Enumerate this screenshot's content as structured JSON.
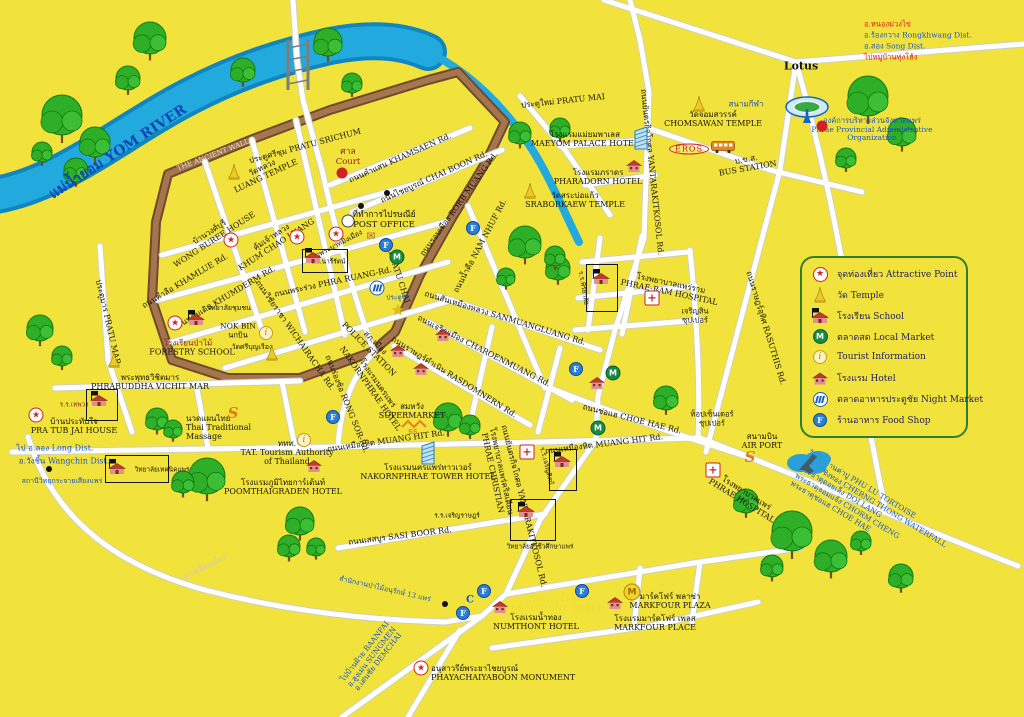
{
  "colors": {
    "background": "#f2e33c",
    "river": "#1b9cd6",
    "wall": "#6f4a2d",
    "road": "#ffffff",
    "thai_blue": "#1a57c4",
    "red": "#d42020",
    "legend_border": "#2e7d32"
  },
  "legend": {
    "items": [
      {
        "icon": "star",
        "text": "จุดท่องเที่ยว  Attractive Point"
      },
      {
        "icon": "temple",
        "text": "วัด  Temple"
      },
      {
        "icon": "school",
        "text": "โรงเรียน  School"
      },
      {
        "icon": "market",
        "text": "ตลาดสด  Local Market"
      },
      {
        "icon": "info",
        "text": "Tourist  Information"
      },
      {
        "icon": "hotel",
        "text": "โรงแรม  Hotel"
      },
      {
        "icon": "nightmarket",
        "text": "ตลาดอาหารประตูชัย  Night Market"
      },
      {
        "icon": "foodshop",
        "text": "ร้านอาหาร  Food Shop"
      }
    ]
  },
  "labels": [
    {
      "n": "yom-river-label",
      "t": "แม่น้ำยอม   YOM RIVER",
      "x": 118,
      "y": 152,
      "r": -33,
      "c": "#0d47b0",
      "s": 14,
      "w": 700
    },
    {
      "n": "ancient-wall-label",
      "t": "THE ANCIENT WALL",
      "x": 213,
      "y": 155,
      "r": -21,
      "c": "#e9e2cf",
      "s": 7
    },
    {
      "n": "pratu-srichum-label",
      "t": "ประตูศรีชุม PRATU SRICHUM",
      "x": 305,
      "y": 146,
      "r": -15
    },
    {
      "n": "court-label",
      "t": "ศาล\nCourt",
      "x": 348,
      "y": 158,
      "c": "#8c1f1f",
      "s": 8.5
    },
    {
      "n": "khamsaen-rd-label",
      "t": "ถนนคำแสน KHAMSAEN Rd.",
      "x": 400,
      "y": 158,
      "r": -24
    },
    {
      "n": "chaiboon-rd-label",
      "t": "ถนนไชยบูรณ์ CHAI BOON Rd.",
      "x": 434,
      "y": 177,
      "r": -24
    },
    {
      "n": "rorbmuang-rd-label",
      "t": "ถนนรอบเมือง RORB MUANG Rd.",
      "x": 459,
      "y": 204,
      "r": -54
    },
    {
      "n": "namnhue-rd-label",
      "t": "ถนนน้ำคือ NAM NHUF Rd.",
      "x": 480,
      "y": 246,
      "r": -62
    },
    {
      "n": "post-office-label",
      "t": "ที่ทำการไปรษณีย์\nPOST OFFICE",
      "x": 384,
      "y": 221,
      "s": 8.5
    },
    {
      "n": "luang-temple-label",
      "t": "วัดหลวง\nLUANG TEMPLE",
      "x": 264,
      "y": 172,
      "r": -25
    },
    {
      "n": "wongburee-house-label",
      "t": "บ้านวงศ์บุรี\nWONG BUREE HOUSE",
      "x": 212,
      "y": 236,
      "r": -33
    },
    {
      "n": "khumchao-luang-label",
      "t": "คุ้มเจ้าหลวง\nKHUM CHAO LUANG",
      "x": 274,
      "y": 241,
      "r": -33
    },
    {
      "n": "phrabat-temple-label",
      "t": "วัดพระบาทมิ่งเมือง",
      "x": 337,
      "y": 245,
      "r": -28,
      "s": 7
    },
    {
      "n": "nareerat-school-label",
      "t": "ร.ร.นารีรัตน์",
      "x": 328,
      "y": 262,
      "s": 6.5
    },
    {
      "n": "khamlue-rd-label",
      "t": "ถนนคำลือ KHAMLUE Rd.",
      "x": 185,
      "y": 281,
      "r": -31
    },
    {
      "n": "khumderm-rd-label",
      "t": "ถนนคุ้มเดิม KHUMDERM Rd.",
      "x": 226,
      "y": 297,
      "r": -31
    },
    {
      "n": "wichairacha-rd-label",
      "t": "ถนนวิชัยราชา WICHAIRACHA Rd.",
      "x": 295,
      "y": 335,
      "r": 55
    },
    {
      "n": "phraruang-rd-label",
      "t": "ถนนพระร่วง PHRA RUANG-Rd.",
      "x": 333,
      "y": 282,
      "r": -12
    },
    {
      "n": "phatuchai-label",
      "t": "PHATU CHAI",
      "x": 399,
      "y": 277,
      "r": 72
    },
    {
      "n": "phatuchai-thai-label",
      "t": "ประตูชัย",
      "x": 398,
      "y": 298,
      "c": "#1a57c4",
      "s": 6.5
    },
    {
      "n": "community-college-label",
      "t": "วิทยาลัยชุมชน",
      "x": 229,
      "y": 308,
      "s": 7
    },
    {
      "n": "nokbin-label",
      "t": "NOK BIN\nนกบิน",
      "x": 238,
      "y": 331,
      "s": 7.5
    },
    {
      "n": "sriboonruang-temple-label",
      "t": "วัดศรีบุญเรือง",
      "x": 252,
      "y": 347,
      "s": 7
    },
    {
      "n": "forestry-school-thai-label",
      "t": "โรงเรียนป่าไม้",
      "x": 188,
      "y": 343,
      "c": "#8c1f1f"
    },
    {
      "n": "forestry-school-label",
      "t": "FORESTRY SCHOOL",
      "x": 192,
      "y": 352
    },
    {
      "n": "pratumar-label",
      "t": "ประตูมาร PRATU MAR",
      "x": 108,
      "y": 322,
      "r": 77
    },
    {
      "n": "phrabuddha-vichitmar-label",
      "t": "พระพุทธวิชิตมาร\nPHRABUDDHA VICHIT MAR",
      "x": 150,
      "y": 382
    },
    {
      "n": "thepwong-school-label",
      "t": "ร.ร.เทพวง",
      "x": 74,
      "y": 405,
      "s": 6.5,
      "c": "#8c1f1f"
    },
    {
      "n": "pratubjai-house-label",
      "t": "บ้านประทับใจ\nPRA TUB JAI HOUSE",
      "x": 74,
      "y": 426
    },
    {
      "n": "long-dist-label",
      "t": "ไป อ.ลอง Long Dist.",
      "x": 55,
      "y": 448,
      "c": "#1a57c4"
    },
    {
      "n": "wangchin-dist-label",
      "t": "อ.วังชิ้น Wangchin Dist.",
      "x": 64,
      "y": 461,
      "c": "#1a57c4"
    },
    {
      "n": "radio-station-label",
      "t": "สถานีวิทยุกระจายเสียงแพร่",
      "x": 62,
      "y": 481,
      "s": 7,
      "c": "#1a57c4"
    },
    {
      "n": "technic-college-label",
      "t": "วิทยาลัยเทคนิคแพร่",
      "x": 162,
      "y": 470,
      "s": 6.5
    },
    {
      "n": "massage-label",
      "t": "นวดแผนไทย\nThai Traditional\nMassage",
      "x": 186,
      "y": 428,
      "a": "l"
    },
    {
      "n": "tat-label",
      "t": "ททท.\nTAT. Tourism Authority\nof Thailand",
      "x": 287,
      "y": 453
    },
    {
      "n": "poomthai-hotel-label",
      "t": "โรงแรมภูมิไทยการ์เด้นท์\nPOOMTHAIGRADEN HOTEL",
      "x": 283,
      "y": 487
    },
    {
      "n": "rongsor-rd-label",
      "t": "ถนนร่องซ้อ RONG SOR-Rd.",
      "x": 347,
      "y": 404,
      "r": 68
    },
    {
      "n": "nakornphrae-hotel-label",
      "t": "โรงแรมนครแพร่\nNAKORNPHRAE HOTEL",
      "x": 374,
      "y": 386,
      "r": 55
    },
    {
      "n": "police-station-label",
      "t": "สภ.เมือง\nPOLICE STATION",
      "x": 372,
      "y": 346,
      "r": 45
    },
    {
      "n": "supermarket-label",
      "t": "สมหวัง\nSUPERMARKET",
      "x": 412,
      "y": 411
    },
    {
      "n": "muanghit-rd-west-label",
      "t": "ถนนเหมืองหิต MUANG HIT Rd.",
      "x": 386,
      "y": 441,
      "r": -8
    },
    {
      "n": "nakornphrae-tower-label",
      "t": "โรงแรมนครแพร่ทาวเวอร์\nNAKORNPHRAE TOWER HOTEL",
      "x": 428,
      "y": 472
    },
    {
      "n": "rasdomnern-rd-label",
      "t": "ถนนราษฎร์ดำเนิน RASDOMNERN Rd.",
      "x": 454,
      "y": 377,
      "r": 32
    },
    {
      "n": "charoenmuang-rd-label",
      "t": "ถนนเจริญเมือง CHAROENMUANG Rd.",
      "x": 484,
      "y": 351,
      "r": 27
    },
    {
      "n": "sanmuangluang-rd-label",
      "t": "ถนนสันเหมืองหลวง SANMUANGLUANG Rd.",
      "x": 505,
      "y": 318,
      "r": 17
    },
    {
      "n": "phrae-christian-label",
      "t": "โรงพยาบาลแพร่คริสเตียน\nPHRAE CHRISTIAN",
      "x": 497,
      "y": 472,
      "r": 78
    },
    {
      "n": "yantarakitkosol-rd-south-label",
      "t": "ถนนยันตรกิจโกศล YANTARAKITKOSOL Rd.",
      "x": 524,
      "y": 506,
      "r": 76
    },
    {
      "n": "charoensin-school-label",
      "t": "ร.ร.เจริญศิลป์",
      "x": 546,
      "y": 466,
      "r": 76,
      "s": 6.5
    },
    {
      "n": "sasiboon-rd-label",
      "t": "ถนนเสสบูร SASI BOOR Rd.",
      "x": 400,
      "y": 536,
      "r": -7
    },
    {
      "n": "charoenrat-school-label",
      "t": "ร.ร.เจริญราษฎร์",
      "x": 457,
      "y": 516,
      "s": 6.5
    },
    {
      "n": "vocational-college-label",
      "t": "วิทยาลัยอาชีวศึก​ษาแพร่",
      "x": 540,
      "y": 547,
      "s": 6.5
    },
    {
      "n": "forest-office-label",
      "t": "สำนักงานป่าไม้อนุรักษ์ 13 แพร่",
      "x": 385,
      "y": 589,
      "r": 13,
      "s": 7,
      "c": "#1a57c4"
    },
    {
      "n": "c-point-label",
      "t": "C",
      "x": 470,
      "y": 600,
      "s": 10,
      "c": "#1a57c4",
      "w": 700
    },
    {
      "n": "numthont-road-label",
      "t": "โรงแรมน้ำทอง\nNUMTHONT HOTEL",
      "x": 557,
      "y": 604,
      "c": "#f0df2e",
      "w": 700
    },
    {
      "n": "numthont-hotel-label",
      "t": "โรงแรมน้ำทอง\nNUMTHONT HOTEL",
      "x": 536,
      "y": 622
    },
    {
      "n": "markfour-plaza-label",
      "t": "มาร์คโฟร์ พลาซ่า\nMARKFOUR PLAZA",
      "x": 670,
      "y": 601
    },
    {
      "n": "markfour-place-label",
      "t": "โรงแรมมาร์คโฟร์ เพลส\nMARKFOUR  PLACE",
      "x": 655,
      "y": 623
    },
    {
      "n": "monument-label",
      "t": "อนุสาวรีย์พระยาไชยบูรณ์\nPHAYACHAIYABOON MONUMENT",
      "x": 431,
      "y": 673,
      "a": "l"
    },
    {
      "n": "baanfai-sungmen-demchai-label",
      "t": "ไปบ้านฝ้าย BAANFAI\nอ.สูงเม่น SUNGMEN\nอ.เด่นชัย DEMCHAI",
      "x": 372,
      "y": 657,
      "r": -52,
      "c": "#1a57c4",
      "s": 7.5
    },
    {
      "n": "bypass-rd-label",
      "t": "ทางเลี่ยงเมือง",
      "x": 205,
      "y": 567,
      "r": -27,
      "c": "#cfcab0"
    },
    {
      "n": "choehae-rd-label",
      "t": "ถนนช่อแฮ CHOE HAE Rd.",
      "x": 632,
      "y": 419,
      "r": 14
    },
    {
      "n": "muanghit-rd-east-label",
      "t": "ถนนเหมืองหิต MUANG HIT Rd.",
      "x": 604,
      "y": 444,
      "r": -7
    },
    {
      "n": "top-center-super-label",
      "t": "ท็อปเซ็นเตอร์\nซุปเปอร์",
      "x": 712,
      "y": 419,
      "s": 7.5
    },
    {
      "n": "airport-label",
      "t": "สนามบิน\nAIR PORT",
      "x": 762,
      "y": 441
    },
    {
      "n": "phrae-hospital-label",
      "t": "โรงพยาบาลแพร่\nPHRAE HOSPITAL",
      "x": 744,
      "y": 497,
      "r": 32
    },
    {
      "n": "destinations-label",
      "t": "ไปหมู่บ้านค่าปู  PHU LU TORTOISE\nน้ำตกเชิงทอง  CHERNG THONG WATERFALL\nพระธาตุดอยเล็ง  DOI LANG\nพระธาตุจอมแจ้ง  CHORM CHENG\nพระธาตุช่อแฮ  CHOE HAE",
      "x": 800,
      "y": 468,
      "r": 31,
      "c": "#1a57c4",
      "s": 7.5,
      "a": "l"
    },
    {
      "n": "rasuthis-rd-label",
      "t": "ถนนราษฎร์อุทิศ RASUTHIS Rd.",
      "x": 766,
      "y": 328,
      "r": 73
    },
    {
      "n": "charoensin-super-label",
      "t": "เจริญสิน\nซุปเปอร์",
      "x": 695,
      "y": 316,
      "s": 7.5
    },
    {
      "n": "phraeram-hospital-label",
      "t": "โรงพยาบาลแพร่ราม\nPHRAE-RAM HOSPITAL",
      "x": 670,
      "y": 288,
      "r": 12
    },
    {
      "n": "piriyalai-school-label",
      "t": "ร.ร.พิริยาลัย",
      "x": 583,
      "y": 288,
      "r": 80,
      "s": 6.5
    },
    {
      "n": "yantarakitkosol-rd-north-label",
      "t": "ถนนยันตรกิจโกศล YANTARAKITKOSOL Rd.",
      "x": 652,
      "y": 172,
      "r": 84
    },
    {
      "n": "bus-station-label",
      "t": "บ.ข.ส.\nBUS STATION",
      "x": 747,
      "y": 164,
      "r": -10
    },
    {
      "n": "chomsawan-temple-label",
      "t": "วัดจอมสวรรค์\nCHOMSAWAN TEMPLE",
      "x": 713,
      "y": 119
    },
    {
      "n": "stadium-label",
      "t": "สนามกีฬา",
      "x": 746,
      "y": 104,
      "c": "#1a57c4"
    },
    {
      "n": "pao-label",
      "t": "องค์การบริหารส่วนจังหวัดแพร่\nPhrae Provincial Administrative Organization",
      "x": 872,
      "y": 130,
      "c": "#1a57c4",
      "s": 7.5
    },
    {
      "n": "lotus-label",
      "t": "Lotus",
      "x": 801,
      "y": 67,
      "s": 11,
      "w": 700
    },
    {
      "n": "nongmuangkhai-label",
      "t": "อ.หนองม่วงไข่",
      "x": 864,
      "y": 25,
      "c": "#d42020",
      "s": 7.5,
      "a": "l"
    },
    {
      "n": "rongkhwang-label",
      "t": "อ.ร้องกวาง Rongkhwang Dist.",
      "x": 864,
      "y": 36,
      "c": "#1a57c4",
      "s": 7.5,
      "a": "l"
    },
    {
      "n": "song-dist-label",
      "t": "อ.สอง Song Dist.",
      "x": 864,
      "y": 47,
      "c": "#1a57c4",
      "s": 7.5,
      "a": "l"
    },
    {
      "n": "thunghong-label",
      "t": "ไปหมู่บ้านทุ่งโฮ้ง",
      "x": 864,
      "y": 58,
      "c": "#d42020",
      "s": 7.5,
      "a": "l"
    },
    {
      "n": "maeyom-palace-label",
      "t": "โรงแรมแม่ยมพาเลส\nMAEYOM PALACE HOTEL",
      "x": 585,
      "y": 139
    },
    {
      "n": "pratumai-label",
      "t": "ประตูใหม่ PRATU MAI",
      "x": 563,
      "y": 101,
      "r": -6
    },
    {
      "n": "pharadorn-hotel-label",
      "t": "โรงแรมภราดร\nPHARADORN HOTEL",
      "x": 598,
      "y": 177
    },
    {
      "n": "sraborkaew-temple-label",
      "t": "วัดสระบ่อแก้ว\nSRABORKAEW TEMPLE",
      "x": 575,
      "y": 200
    }
  ],
  "icons": [
    {
      "n": "attraction-pratubjai",
      "t": "star",
      "x": 36,
      "y": 415
    },
    {
      "n": "attraction-forestry",
      "t": "star",
      "x": 175,
      "y": 323
    },
    {
      "n": "attraction-wongburee",
      "t": "star",
      "x": 231,
      "y": 240
    },
    {
      "n": "attraction-khumchao",
      "t": "star",
      "x": 297,
      "y": 237
    },
    {
      "n": "attraction-phrabat",
      "t": "star",
      "x": 336,
      "y": 234
    },
    {
      "n": "attraction-monument",
      "t": "star",
      "x": 421,
      "y": 668
    },
    {
      "n": "gold-star-marker",
      "t": "goldstar",
      "x": 398,
      "y": 310
    },
    {
      "n": "temple-luang",
      "t": "temple",
      "x": 234,
      "y": 172
    },
    {
      "n": "temple-sriboonruang",
      "t": "temple",
      "x": 272,
      "y": 353
    },
    {
      "n": "temple-west-chedi",
      "t": "temple",
      "x": 114,
      "y": 360
    },
    {
      "n": "temple-sraborkaew",
      "t": "temple",
      "x": 530,
      "y": 191
    },
    {
      "n": "temple-chomsawan",
      "t": "temple",
      "x": 699,
      "y": 104
    },
    {
      "n": "school-forestry",
      "t": "school",
      "x": 196,
      "y": 318
    },
    {
      "n": "school-thepwong",
      "t": "school",
      "x": 99,
      "y": 399
    },
    {
      "n": "school-technic",
      "t": "school",
      "x": 117,
      "y": 467
    },
    {
      "n": "school-nareerat",
      "t": "school",
      "x": 313,
      "y": 256
    },
    {
      "n": "school-piriyalai",
      "t": "school",
      "x": 601,
      "y": 277
    },
    {
      "n": "school-charoensin",
      "t": "school",
      "x": 562,
      "y": 460
    },
    {
      "n": "school-vocational",
      "t": "school",
      "x": 526,
      "y": 510
    },
    {
      "n": "school-box-nareerat",
      "t": "schoolbox",
      "x": 325,
      "y": 261,
      "w": 44,
      "h": 22
    },
    {
      "n": "school-box-thepwong",
      "t": "schoolbox",
      "x": 102,
      "y": 405,
      "w": 30,
      "h": 30
    },
    {
      "n": "school-box-technic",
      "t": "schoolbox",
      "x": 137,
      "y": 469,
      "w": 62,
      "h": 26
    },
    {
      "n": "school-box-piriyalai",
      "t": "schoolbox",
      "x": 602,
      "y": 288,
      "w": 30,
      "h": 46
    },
    {
      "n": "school-box-charoensin",
      "t": "schoolbox",
      "x": 563,
      "y": 470,
      "w": 26,
      "h": 40
    },
    {
      "n": "school-box-vocational",
      "t": "schoolbox",
      "x": 533,
      "y": 520,
      "w": 44,
      "h": 40
    },
    {
      "n": "hotel-pharadorn",
      "t": "hotel",
      "x": 634,
      "y": 166
    },
    {
      "n": "hotel-poomthai",
      "t": "hotel",
      "x": 314,
      "y": 466
    },
    {
      "n": "hotel-numthont",
      "t": "hotel",
      "x": 500,
      "y": 607
    },
    {
      "n": "hotel-markfour",
      "t": "hotel",
      "x": 615,
      "y": 603
    },
    {
      "n": "hotel-charoenmuang-1",
      "t": "hotel",
      "x": 443,
      "y": 335
    },
    {
      "n": "hotel-charoenmuang-2",
      "t": "hotel",
      "x": 398,
      "y": 351
    },
    {
      "n": "hotel-charoenmuang-3",
      "t": "hotel",
      "x": 421,
      "y": 369
    },
    {
      "n": "hotel-east",
      "t": "hotel",
      "x": 597,
      "y": 383
    },
    {
      "n": "market-pratuchai",
      "t": "market",
      "x": 397,
      "y": 257
    },
    {
      "n": "market-east-1",
      "t": "market",
      "x": 613,
      "y": 373
    },
    {
      "n": "market-east-2",
      "t": "market",
      "x": 598,
      "y": 428
    },
    {
      "n": "info-nokbin",
      "t": "info",
      "x": 266,
      "y": 333
    },
    {
      "n": "info-tat",
      "t": "info",
      "x": 304,
      "y": 440
    },
    {
      "n": "nightmarket-pratuchai",
      "t": "nightmarket",
      "x": 377,
      "y": 288
    },
    {
      "n": "foodshop-1",
      "t": "foodshop",
      "x": 386,
      "y": 245
    },
    {
      "n": "foodshop-2",
      "t": "foodshop",
      "x": 473,
      "y": 228
    },
    {
      "n": "foodshop-3",
      "t": "foodshop",
      "x": 576,
      "y": 369
    },
    {
      "n": "foodshop-4",
      "t": "foodshop",
      "x": 333,
      "y": 417
    },
    {
      "n": "foodshop-5",
      "t": "foodshop",
      "x": 484,
      "y": 591
    },
    {
      "n": "foodshop-6",
      "t": "foodshop",
      "x": 582,
      "y": 591
    },
    {
      "n": "foodshop-7",
      "t": "foodshop",
      "x": 463,
      "y": 613
    },
    {
      "n": "cross-phraeram",
      "t": "cross",
      "x": 652,
      "y": 298
    },
    {
      "n": "cross-christian",
      "t": "cross",
      "x": 527,
      "y": 452
    },
    {
      "n": "cross-phrae-hospital",
      "t": "cross",
      "x": 713,
      "y": 470
    },
    {
      "n": "dot-court",
      "t": "dotred",
      "x": 342,
      "y": 173
    },
    {
      "n": "dot-pao",
      "t": "dotred",
      "x": 822,
      "y": 126
    },
    {
      "n": "dot-b1",
      "t": "dotblack",
      "x": 361,
      "y": 206
    },
    {
      "n": "dot-b2",
      "t": "dotblack",
      "x": 387,
      "y": 193
    },
    {
      "n": "dot-b3",
      "t": "dotblack",
      "x": 445,
      "y": 604
    },
    {
      "n": "dot-b4",
      "t": "dotblack",
      "x": 49,
      "y": 469
    },
    {
      "n": "bus-icon",
      "t": "bus",
      "x": 723,
      "y": 147
    },
    {
      "n": "stadium-icon",
      "t": "stadium",
      "x": 807,
      "y": 110
    },
    {
      "n": "airplane-icon",
      "t": "plane",
      "x": 810,
      "y": 462
    },
    {
      "n": "tower-maeyom",
      "t": "tower",
      "x": 641,
      "y": 138
    },
    {
      "n": "tower-nakornphrae",
      "t": "tower",
      "x": 428,
      "y": 453
    },
    {
      "n": "massage-s-icon",
      "t": "sletter",
      "x": 233,
      "y": 413
    },
    {
      "n": "airport-s-icon",
      "t": "sletter",
      "x": 750,
      "y": 457
    },
    {
      "n": "supermarket-ss-icon",
      "t": "ss",
      "x": 414,
      "y": 427
    },
    {
      "n": "markfour-m-icon",
      "t": "mcrown",
      "x": 632,
      "y": 592
    },
    {
      "n": "post-office-circle",
      "t": "pocircle",
      "x": 348,
      "y": 221
    },
    {
      "n": "envelope-icon",
      "t": "envelope",
      "x": 371,
      "y": 236
    },
    {
      "n": "eros-badge",
      "t": "eros",
      "x": 689,
      "y": 149,
      "label": "EROS"
    }
  ]
}
